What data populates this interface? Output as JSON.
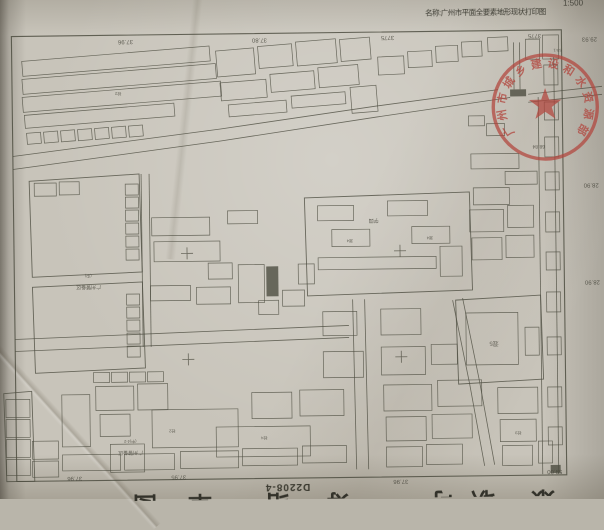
{
  "header": {
    "title": "名称:广州市平面全要素地形现状打印图",
    "scale": "1:500"
  },
  "bottom_strip": {
    "sheet_number": "D2208-4",
    "large_clipped_chars": [
      "图",
      "覃",
      "给",
      "筹",
      "可",
      "职",
      "臮"
    ],
    "char_x": [
      130,
      185,
      262,
      322,
      428,
      468,
      528
    ]
  },
  "stamp": {
    "text": "广州市城乡建设和水资源部",
    "cx": 547,
    "cy": 110,
    "r": 52,
    "text_radius": 40,
    "star_outer": 17,
    "star_inner": 6.8,
    "color": "#b2443c"
  },
  "colors": {
    "paper": "#c8c4ba",
    "ink": "#4e4d41",
    "label_ink": "#45443a",
    "stamp_red": "#b2443c"
  },
  "map": {
    "frame": {
      "x": 14,
      "y": 33,
      "w": 550,
      "h": 445
    },
    "margin_labels": [
      {
        "t": "37.96",
        "x": 128,
        "y": 38,
        "rot": 180
      },
      {
        "t": "37.80",
        "x": 262,
        "y": 38,
        "rot": 180
      },
      {
        "t": "3775",
        "x": 390,
        "y": 37,
        "rot": 180
      },
      {
        "t": "3775",
        "x": 537,
        "y": 37,
        "rot": 180
      },
      {
        "t": "29.93",
        "x": 592,
        "y": 41,
        "rot": 180
      },
      {
        "t": "28.90",
        "x": 592,
        "y": 187,
        "rot": 180
      },
      {
        "t": "28.90",
        "x": 592,
        "y": 284,
        "rot": 180
      },
      {
        "t": "37.96",
        "x": 72,
        "y": 474,
        "rot": 180
      },
      {
        "t": "37.95",
        "x": 176,
        "y": 474,
        "rot": 180
      },
      {
        "t": "37.96",
        "x": 398,
        "y": 481,
        "rot": 180
      },
      {
        "t": "59.00",
        "x": 552,
        "y": 473,
        "rot": 180
      }
    ],
    "tiny_labels": [
      {
        "t": "(中)",
        "x": 88,
        "y": 272,
        "rot": 180,
        "s": 4
      },
      {
        "t": "广州警备区",
        "x": 88,
        "y": 283,
        "rot": 180,
        "s": 5
      },
      {
        "t": "(中)4-2",
        "x": 128,
        "y": 438,
        "rot": 180,
        "s": 4
      },
      {
        "t": "广州警备区",
        "x": 128,
        "y": 449,
        "rot": 180,
        "s": 5
      },
      {
        "t": "学园",
        "x": 374,
        "y": 220,
        "rot": 180,
        "s": 5
      },
      {
        "t": "混4",
        "x": 350,
        "y": 240,
        "rot": 180,
        "s": 4
      },
      {
        "t": "混4",
        "x": 430,
        "y": 238,
        "rot": 180,
        "s": 4
      },
      {
        "t": "混5",
        "x": 493,
        "y": 344,
        "rot": 180,
        "s": 6
      },
      {
        "t": "68.84",
        "x": 540,
        "y": 148,
        "rot": 180,
        "s": 5
      },
      {
        "t": "砼3",
        "x": 516,
        "y": 434,
        "rot": 180,
        "s": 4
      },
      {
        "t": "砼2",
        "x": 170,
        "y": 428,
        "rot": 180,
        "s": 4
      },
      {
        "t": "砼2",
        "x": 120,
        "y": 90,
        "rot": 180,
        "s": 4
      },
      {
        "t": "砼4",
        "x": 262,
        "y": 436,
        "rot": 180,
        "s": 4
      },
      {
        "t": "53-1",
        "x": 560,
        "y": 52,
        "rot": 180,
        "s": 4
      }
    ],
    "roads": [
      [
        [
          14,
          166
        ],
        [
          222,
          140
        ],
        [
          378,
          118
        ],
        [
          512,
          100
        ]
      ],
      [
        [
          14,
          153
        ],
        [
          222,
          128
        ],
        [
          378,
          107
        ],
        [
          500,
          92
        ]
      ],
      [
        [
          530,
          97
        ],
        [
          604,
          90
        ]
      ],
      [
        [
          530,
          105
        ],
        [
          604,
          98
        ]
      ],
      [
        [
          540,
          100
        ],
        [
          540,
          477
        ]
      ],
      [
        [
          556,
          60
        ],
        [
          556,
          477
        ]
      ],
      [
        [
          14,
          336
        ],
        [
          348,
          326
        ]
      ],
      [
        [
          14,
          348
        ],
        [
          348,
          338
        ]
      ],
      [
        [
          352,
          300
        ],
        [
          354,
          470
        ]
      ],
      [
        [
          364,
          300
        ],
        [
          366,
          470
        ]
      ],
      [
        [
          452,
          302
        ],
        [
          468,
          386
        ],
        [
          482,
          468
        ]
      ],
      [
        [
          462,
          300
        ],
        [
          478,
          384
        ],
        [
          492,
          467
        ]
      ],
      [
        [
          142,
          172
        ],
        [
          142,
          345
        ]
      ],
      [
        [
          150,
          172
        ],
        [
          150,
          345
        ]
      ],
      [
        [
          516,
          45
        ],
        [
          516,
          92
        ]
      ],
      [
        [
          522,
          45
        ],
        [
          522,
          92
        ]
      ]
    ],
    "parcels": [
      [
        [
          30,
          178
        ],
        [
          140,
          172
        ],
        [
          142,
          270
        ],
        [
          32,
          274
        ]
      ],
      [
        [
          32,
          284
        ],
        [
          142,
          280
        ],
        [
          144,
          366
        ],
        [
          34,
          370
        ]
      ],
      [
        [
          305,
          198
        ],
        [
          470,
          194
        ],
        [
          472,
          292
        ],
        [
          307,
          296
        ]
      ],
      [
        [
          455,
          302
        ],
        [
          540,
          298
        ],
        [
          542,
          382
        ],
        [
          457,
          386
        ]
      ],
      [
        [
          2,
          390
        ],
        [
          30,
          388
        ],
        [
          32,
          478
        ],
        [
          4,
          478
        ]
      ]
    ],
    "crosses": [
      [
        187,
        252
      ],
      [
        400,
        252
      ],
      [
        187,
        358
      ],
      [
        400,
        358
      ]
    ],
    "filled": [
      [
        512,
        92,
        16,
        7
      ],
      [
        266,
        266,
        12,
        30
      ],
      [
        548,
        468,
        10,
        8
      ]
    ],
    "buildings": [
      [
        24,
        58,
        188,
        15,
        -4
      ],
      [
        24,
        76,
        194,
        15,
        -4
      ],
      [
        24,
        94,
        199,
        15,
        -4
      ],
      [
        26,
        112,
        150,
        13,
        -4
      ],
      [
        28,
        130,
        14,
        11,
        -4
      ],
      [
        45,
        129,
        14,
        11,
        -4
      ],
      [
        62,
        128,
        14,
        11,
        -4
      ],
      [
        79,
        127,
        14,
        11,
        -4
      ],
      [
        96,
        126,
        14,
        11,
        -4
      ],
      [
        113,
        125,
        14,
        11,
        -4
      ],
      [
        130,
        124,
        14,
        11,
        -4
      ],
      [
        218,
        50,
        38,
        26,
        -4
      ],
      [
        260,
        46,
        34,
        22,
        -4
      ],
      [
        298,
        42,
        40,
        24,
        -4
      ],
      [
        342,
        40,
        30,
        22,
        -4
      ],
      [
        222,
        82,
        46,
        18,
        -4
      ],
      [
        272,
        74,
        44,
        18,
        -4
      ],
      [
        320,
        68,
        40,
        20,
        -4
      ],
      [
        230,
        104,
        58,
        12,
        -4
      ],
      [
        293,
        96,
        54,
        12,
        -4
      ],
      [
        352,
        88,
        26,
        26,
        -4
      ],
      [
        380,
        58,
        26,
        18,
        -2
      ],
      [
        410,
        53,
        24,
        16,
        -2
      ],
      [
        438,
        48,
        22,
        16,
        -2
      ],
      [
        464,
        44,
        20,
        15,
        -2
      ],
      [
        490,
        40,
        20,
        14,
        -2
      ],
      [
        545,
        38,
        16,
        24,
        0
      ],
      [
        528,
        42,
        14,
        20,
        0
      ],
      [
        126,
        182,
        13,
        11,
        0
      ],
      [
        126,
        195,
        13,
        11,
        0
      ],
      [
        126,
        208,
        13,
        11,
        0
      ],
      [
        126,
        221,
        13,
        11,
        0
      ],
      [
        126,
        234,
        13,
        11,
        0
      ],
      [
        126,
        247,
        13,
        11,
        0
      ],
      [
        126,
        292,
        13,
        11,
        0
      ],
      [
        126,
        305,
        13,
        11,
        0
      ],
      [
        126,
        318,
        13,
        11,
        0
      ],
      [
        126,
        331,
        13,
        11,
        0
      ],
      [
        126,
        344,
        13,
        11,
        0
      ],
      [
        35,
        180,
        22,
        13,
        0
      ],
      [
        60,
        179,
        20,
        13,
        0
      ],
      [
        152,
        216,
        58,
        18,
        0
      ],
      [
        154,
        240,
        66,
        20,
        0
      ],
      [
        228,
        210,
        30,
        13,
        0
      ],
      [
        150,
        284,
        40,
        15,
        0
      ],
      [
        196,
        286,
        34,
        17,
        0
      ],
      [
        238,
        264,
        26,
        38,
        0
      ],
      [
        282,
        290,
        22,
        16,
        0
      ],
      [
        298,
        264,
        16,
        20,
        0
      ],
      [
        258,
        300,
        20,
        14,
        0
      ],
      [
        208,
        262,
        24,
        16,
        0
      ],
      [
        318,
        206,
        36,
        15,
        0
      ],
      [
        388,
        202,
        40,
        15,
        0
      ],
      [
        332,
        230,
        38,
        17,
        0
      ],
      [
        412,
        228,
        38,
        17,
        0
      ],
      [
        318,
        258,
        118,
        12,
        0
      ],
      [
        440,
        248,
        22,
        30,
        0
      ],
      [
        472,
        156,
        48,
        15,
        0
      ],
      [
        506,
        174,
        32,
        13,
        0
      ],
      [
        474,
        190,
        36,
        17,
        0
      ],
      [
        470,
        212,
        34,
        22,
        0
      ],
      [
        508,
        208,
        26,
        22,
        0
      ],
      [
        472,
        240,
        30,
        22,
        0
      ],
      [
        506,
        238,
        28,
        22,
        0
      ],
      [
        465,
        315,
        52,
        52,
        0
      ],
      [
        524,
        330,
        14,
        28,
        0
      ],
      [
        546,
        68,
        14,
        20,
        0
      ],
      [
        546,
        105,
        14,
        18,
        0
      ],
      [
        546,
        140,
        14,
        20,
        0
      ],
      [
        546,
        175,
        14,
        18,
        0
      ],
      [
        546,
        215,
        14,
        20,
        0
      ],
      [
        546,
        255,
        14,
        18,
        0
      ],
      [
        546,
        295,
        14,
        20,
        0
      ],
      [
        546,
        340,
        14,
        18,
        0
      ],
      [
        546,
        390,
        14,
        20,
        0
      ],
      [
        546,
        430,
        14,
        18,
        0
      ],
      [
        4,
        396,
        24,
        18,
        0
      ],
      [
        4,
        416,
        24,
        18,
        0
      ],
      [
        4,
        436,
        24,
        18,
        0
      ],
      [
        4,
        456,
        24,
        16,
        0
      ],
      [
        30,
        438,
        26,
        18,
        0
      ],
      [
        30,
        458,
        26,
        16,
        0
      ],
      [
        92,
        370,
        16,
        10,
        0
      ],
      [
        110,
        370,
        16,
        10,
        0
      ],
      [
        128,
        370,
        16,
        10,
        0
      ],
      [
        146,
        370,
        16,
        10,
        0
      ],
      [
        60,
        392,
        28,
        52,
        0
      ],
      [
        94,
        384,
        38,
        24,
        0
      ],
      [
        136,
        382,
        30,
        26,
        0
      ],
      [
        98,
        412,
        30,
        22,
        0
      ],
      [
        150,
        408,
        86,
        38,
        0
      ],
      [
        108,
        442,
        34,
        28,
        0
      ],
      [
        214,
        426,
        94,
        30,
        0
      ],
      [
        250,
        392,
        40,
        26,
        0
      ],
      [
        298,
        390,
        44,
        26,
        0
      ],
      [
        60,
        452,
        58,
        16,
        0
      ],
      [
        122,
        452,
        50,
        16,
        0
      ],
      [
        178,
        450,
        58,
        17,
        0
      ],
      [
        240,
        448,
        55,
        17,
        0
      ],
      [
        300,
        446,
        44,
        17,
        0
      ],
      [
        322,
        352,
        40,
        26,
        0
      ],
      [
        380,
        348,
        44,
        28,
        0
      ],
      [
        430,
        346,
        26,
        20,
        0
      ],
      [
        322,
        312,
        34,
        24,
        0
      ],
      [
        380,
        310,
        40,
        26,
        0
      ],
      [
        382,
        386,
        48,
        26,
        0
      ],
      [
        436,
        382,
        44,
        26,
        0
      ],
      [
        496,
        390,
        40,
        26,
        0
      ],
      [
        384,
        418,
        40,
        24,
        0
      ],
      [
        430,
        416,
        40,
        24,
        0
      ],
      [
        498,
        422,
        36,
        22,
        0
      ],
      [
        384,
        448,
        36,
        20,
        0
      ],
      [
        424,
        446,
        36,
        20,
        0
      ],
      [
        500,
        448,
        30,
        20,
        0
      ],
      [
        536,
        444,
        14,
        22,
        0
      ],
      [
        488,
        126,
        18,
        12,
        0
      ],
      [
        470,
        118,
        16,
        10,
        0
      ]
    ]
  }
}
